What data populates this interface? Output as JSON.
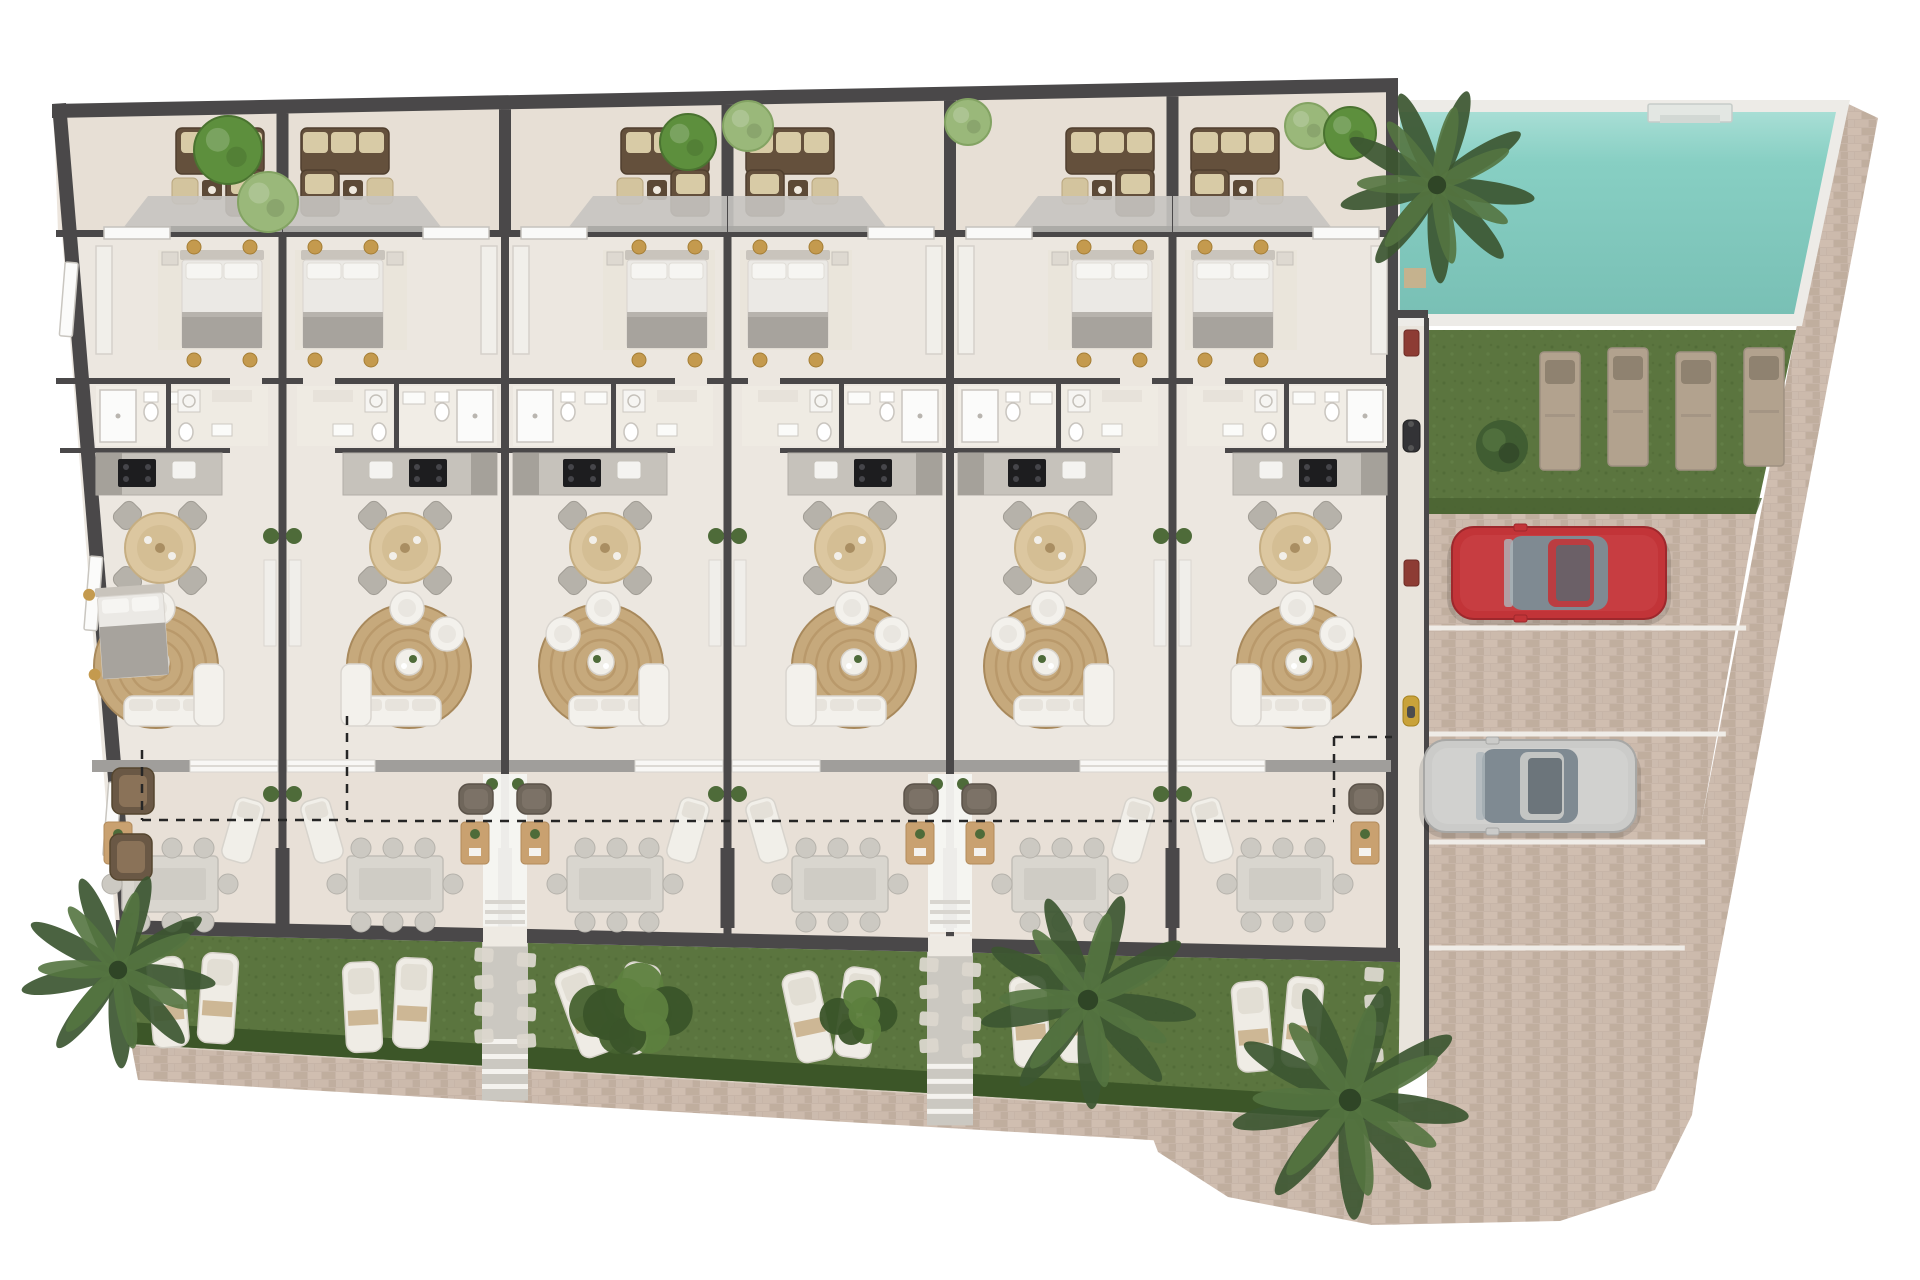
{
  "title": "Residential complex ground floor plan – six terraced apartments with pool, lawn, gardens and parking",
  "colors": {
    "background": "#ffffff",
    "wall": "#4a4849",
    "floor_interior": "#ece7e0",
    "floor_terrace": "#e6dcd1",
    "floor_corridor": "#e9e4dc",
    "canopy": "#c6c4c1",
    "canopy_edge": "#a9a7a4",
    "lintel": "#a09e9b",
    "grass": "#5b753f",
    "grass_dark": "#4a6332",
    "hedge": "#3c5628",
    "pool_water": "#87cfc3",
    "pool_water_light": "#a8ded5",
    "pool_water_dark": "#79c0b5",
    "pool_coping": "#edebe7",
    "brick": "#c7b5a8",
    "brick_light": "#d2c1b3",
    "brick_mid": "#cdbbac",
    "brick_dark": "#b9a795",
    "rug": "#c6a97c",
    "rug_ring": "#b09061",
    "table_wood": "#dcc7a0",
    "table_wood_dark": "#c6ae82",
    "chair_gray": "#b6b2aa",
    "sofa_brown": "#64503c",
    "sofa_brown_dark": "#503f2e",
    "cushion_beige": "#d8cba6",
    "stool_beige": "#d3c49e",
    "pouf_gold": "#c49a4e",
    "pouf_brown": "#8a6f50",
    "white_furniture": "#f3f1ec",
    "white_furniture_line": "#d9d5cf",
    "bed_duvet": "#ebe9e5",
    "bed_blanket": "#a7a39d",
    "headboard": "#c9c4bc",
    "counter": "#c6c2bb",
    "counter_dark": "#a5a19a",
    "cooktop": "#1d1d1f",
    "armchair_dark": "#6f665b",
    "coffee_wood": "#c9a170",
    "lounger_white": "#efece5",
    "lounger_head": "#e2ded4",
    "towel_tan": "#cdb795",
    "lawn_lounger": "#b2a28e",
    "lawn_lounger_head": "#8f8270",
    "pad": "#dbd7ce",
    "stair_strip": "#cbc8c1",
    "step_white": "#f4f2ee",
    "car_red": "#c23438",
    "car_red_dark": "#9e282c",
    "car_silver": "#cbcbc9",
    "car_silver_dark": "#a8a8a6",
    "car_glass": "#7f8a92",
    "line_white": "#efece7",
    "palm_dark": "#3c5631",
    "palm_mid": "#547440",
    "bush_bright": "#5d8f3d",
    "bush_pale": "#9ab87a",
    "plant_green": "#4e6b39",
    "dashed": "#262626"
  },
  "regions": {
    "building_floor": [
      [
        52,
        106
      ],
      [
        1398,
        80
      ],
      [
        1398,
        952
      ],
      [
        116,
        932
      ]
    ],
    "terrace_band": [
      [
        54,
        116
      ],
      [
        1398,
        90
      ],
      [
        1398,
        232
      ],
      [
        58,
        232
      ]
    ],
    "lower_terrace_band": [
      [
        108,
        772
      ],
      [
        1398,
        772
      ],
      [
        1400,
        948
      ],
      [
        116,
        920
      ]
    ],
    "corridor": {
      "x": 1398,
      "y": 318,
      "w": 28,
      "h": 744
    },
    "pool_coping": [
      [
        1392,
        100
      ],
      [
        1850,
        100
      ],
      [
        1802,
        326
      ],
      [
        1392,
        326
      ]
    ],
    "pool_water": [
      [
        1400,
        112
      ],
      [
        1836,
        112
      ],
      [
        1794,
        314
      ],
      [
        1400,
        314
      ]
    ],
    "pool_step_mat": {
      "x": 1404,
      "y": 268,
      "w": 22,
      "h": 20
    },
    "pool_steps": {
      "x": 1648,
      "y": 104,
      "w": 84,
      "h": 18
    },
    "lawn": [
      [
        1427,
        330
      ],
      [
        1796,
        330
      ],
      [
        1756,
        514
      ],
      [
        1427,
        514
      ]
    ],
    "parking": [
      [
        1427,
        514
      ],
      [
        1756,
        514
      ],
      [
        1660,
        1058
      ],
      [
        1427,
        1058
      ]
    ],
    "right_strip": [
      [
        1840,
        100
      ],
      [
        1878,
        118
      ],
      [
        1700,
        1060
      ],
      [
        1656,
        1060
      ]
    ],
    "walkway": [
      [
        131,
        1044
      ],
      [
        1398,
        1122
      ],
      [
        1420,
        1156
      ],
      [
        138,
        1080
      ]
    ],
    "driveway": [
      [
        1427,
        1058
      ],
      [
        1700,
        1058
      ],
      [
        1692,
        1115
      ],
      [
        1655,
        1190
      ],
      [
        1560,
        1221
      ],
      [
        1372,
        1225
      ],
      [
        1228,
        1197
      ],
      [
        1158,
        1152
      ],
      [
        1152,
        1136
      ],
      [
        1427,
        1100
      ]
    ],
    "grass_band": [
      [
        116,
        934
      ],
      [
        1400,
        962
      ],
      [
        1398,
        1122
      ],
      [
        131,
        1044
      ]
    ],
    "hedge_band": [
      [
        128,
        1022
      ],
      [
        1398,
        1100
      ],
      [
        1398,
        1122
      ],
      [
        131,
        1044
      ]
    ]
  },
  "units": [
    {
      "id": "unit-1",
      "mirrored": false,
      "inset": 28,
      "extra_bedroom": true,
      "corner_armchairs": true,
      "garden": {
        "pads_side": null,
        "lounger_angles": [
          -5,
          4
        ],
        "shrubs": false
      }
    },
    {
      "id": "unit-2",
      "mirrored": true,
      "inset": 0,
      "garden": {
        "pads_side": "right",
        "lounger_angles": [
          -3,
          3
        ],
        "shrubs": false
      }
    },
    {
      "id": "unit-3",
      "mirrored": false,
      "inset": 0,
      "garden": {
        "pads_side": "left",
        "lounger_angles": [
          -20,
          12
        ],
        "shrubs": true
      }
    },
    {
      "id": "unit-4",
      "mirrored": true,
      "inset": 0,
      "garden": {
        "pads_side": "right",
        "lounger_angles": [
          -12,
          8
        ],
        "shrubs": false
      }
    },
    {
      "id": "unit-5",
      "mirrored": false,
      "inset": 0,
      "garden": {
        "pads_side": "left",
        "lounger_angles": [
          -4,
          3
        ],
        "shrubs": false
      }
    },
    {
      "id": "unit-6",
      "mirrored": true,
      "inset": 0,
      "garden": {
        "pads_side": "right",
        "lounger_angles": [
          -5,
          5
        ],
        "shrubs": false
      }
    }
  ],
  "entry_paths_x": [
    505,
    950
  ],
  "parking_lines_y": [
    628,
    734,
    842,
    948
  ],
  "cars": [
    {
      "id": "red-car",
      "x": 1452,
      "y": 527,
      "w": 214,
      "h": 92,
      "body": "#c23438",
      "shade": "#9e282c",
      "hilite": "#d4555a"
    },
    {
      "id": "silver-car",
      "x": 1424,
      "y": 740,
      "w": 212,
      "h": 92,
      "body": "#cbcbc9",
      "shade": "#a8a8a6",
      "hilite": "#e2e2e0"
    }
  ],
  "lawn_loungers": [
    {
      "x": 1540,
      "y": 352
    },
    {
      "x": 1608,
      "y": 348
    },
    {
      "x": 1676,
      "y": 352
    },
    {
      "x": 1744,
      "y": 348
    }
  ],
  "corridor_items": [
    {
      "type": "mat-red",
      "x": 1404,
      "y": 330
    },
    {
      "type": "scooter-dark",
      "x": 1403,
      "y": 420
    },
    {
      "type": "mat-red",
      "x": 1404,
      "y": 560
    },
    {
      "type": "scooter-yellow",
      "x": 1403,
      "y": 696
    }
  ],
  "vegetation": [
    {
      "type": "round-tree",
      "x": 228,
      "y": 150,
      "r": 34,
      "tone": "bright"
    },
    {
      "type": "round-tree",
      "x": 268,
      "y": 202,
      "r": 30,
      "tone": "pale"
    },
    {
      "type": "round-tree",
      "x": 688,
      "y": 142,
      "r": 28,
      "tone": "bright"
    },
    {
      "type": "round-tree",
      "x": 748,
      "y": 126,
      "r": 25,
      "tone": "pale"
    },
    {
      "type": "round-tree",
      "x": 968,
      "y": 122,
      "r": 23,
      "tone": "pale"
    },
    {
      "type": "round-tree",
      "x": 1308,
      "y": 126,
      "r": 23,
      "tone": "pale"
    },
    {
      "type": "round-tree",
      "x": 1350,
      "y": 133,
      "r": 26,
      "tone": "bright"
    },
    {
      "type": "palm",
      "x": 118,
      "y": 970,
      "r": 92
    },
    {
      "type": "shrub-cluster",
      "x": 640,
      "y": 1008,
      "r": 62
    },
    {
      "type": "shrub-cluster",
      "x": 860,
      "y": 1012,
      "r": 44
    },
    {
      "type": "palm",
      "x": 1088,
      "y": 1000,
      "r": 102
    },
    {
      "type": "palm",
      "x": 1350,
      "y": 1100,
      "r": 112
    },
    {
      "type": "palm",
      "x": 1437,
      "y": 185,
      "r": 92
    },
    {
      "type": "lawn-tree",
      "x": 1502,
      "y": 446,
      "r": 26
    }
  ],
  "dashed_boundary": [
    [
      [
        142,
        750
      ],
      [
        142,
        820
      ]
    ],
    [
      [
        142,
        820
      ],
      [
        347,
        820
      ]
    ],
    [
      [
        347,
        716
      ],
      [
        347,
        820
      ]
    ],
    [
      [
        347,
        821
      ],
      [
        1334,
        821
      ]
    ],
    [
      [
        1334,
        737
      ],
      [
        1334,
        821
      ]
    ],
    [
      [
        1334,
        737
      ],
      [
        1392,
        737
      ]
    ]
  ]
}
